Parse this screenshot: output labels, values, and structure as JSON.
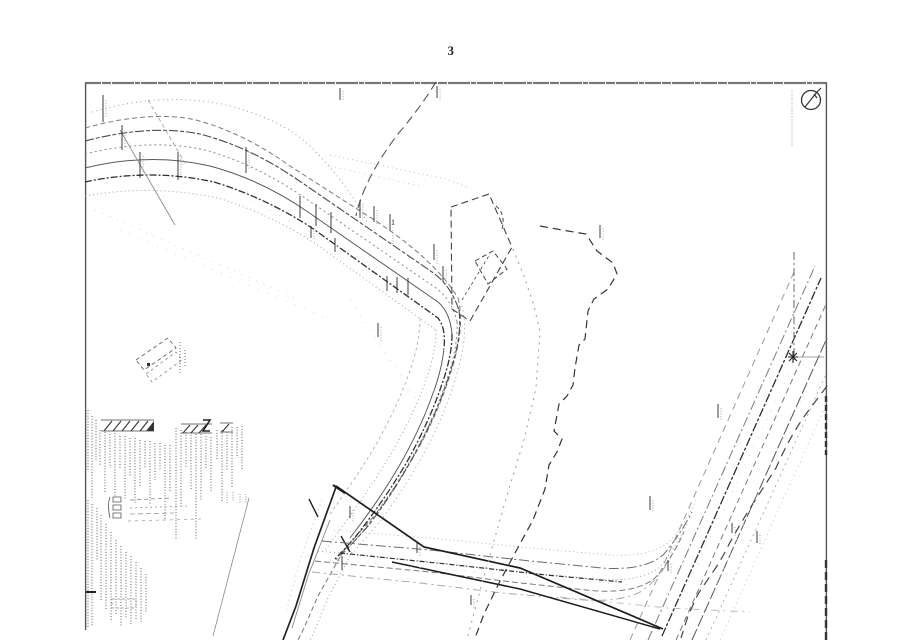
{
  "page": {
    "number": "3"
  },
  "plan": {
    "area_label": "1",
    "icons": {
      "north_arrow": "north-arrow-icon"
    },
    "colors": {
      "paper": "#ffffff",
      "ink": "#1b1b1b",
      "mid_gray": "#6a6a6a",
      "faint_gray": "#9a9a9a"
    }
  }
}
